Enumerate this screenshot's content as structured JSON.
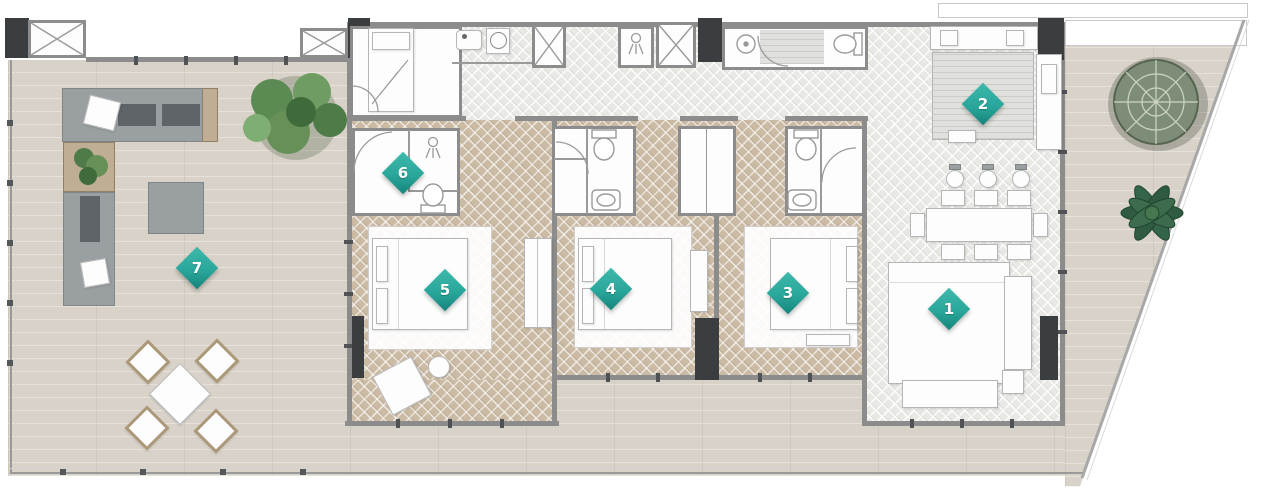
{
  "plan": {
    "markers": [
      {
        "number": "1"
      },
      {
        "number": "2"
      },
      {
        "number": "3"
      },
      {
        "number": "4"
      },
      {
        "number": "5"
      },
      {
        "number": "6"
      },
      {
        "number": "7"
      }
    ],
    "colors": {
      "marker_teal": "#2aa79b",
      "wall_gray": "#8c8c8c",
      "pillar_dark": "#3b3e40",
      "wood_floor": "#d8d2c8",
      "herringbone_gray": "#e8e8e5",
      "herringbone_tan": "#ccbba4",
      "furniture_white": "#fdfdfd",
      "sofa_gray": "#9aa0a2",
      "plant_green": "#55804e"
    }
  }
}
